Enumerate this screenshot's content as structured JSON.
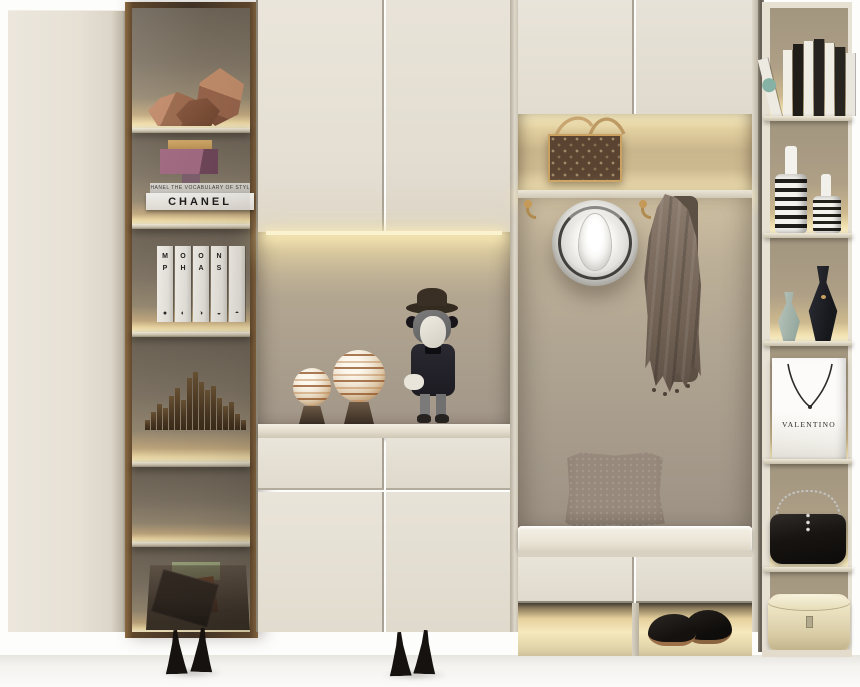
{
  "meta": {
    "description": "3D interior render of a cream built-in entryway wardrobe: glass display tower with lit shelves, cabinet doors, a lit display niche with a collectible figure, a coat area with fedora and scarf on brass hooks, a bench with cushion and shoe cubbies, and an open accessory shelf unit",
    "width": 860,
    "height": 687
  },
  "palette": {
    "cabinet": "#e7e2d7",
    "cabinet_shadow": "#cfc8ba",
    "seam": "#aaa294",
    "wood_frame": "#4e3b2a",
    "tower_wall": "#7d7263",
    "niche_wall": "#b0a592",
    "led_warm": "#f7edc8",
    "brass": "#b08a4e",
    "floor": "#f4f3f0"
  },
  "tower": {
    "shelf_labels": [
      "copper faceted sculptures",
      "sculpture on Chanel books",
      "Moon Phase book set",
      "bronze skyline sculpture",
      "empty lit shelf",
      "smoked acrylic basket with magazines and green box"
    ],
    "chanel": {
      "spine_small": "CHANEL  THE VOCABULARY OF STYLE",
      "spine_large": "CHANEL"
    },
    "moon_books": {
      "visible_text": "MOON PHAS",
      "spines": [
        {
          "t": "M",
          "b": "P",
          "g": "●"
        },
        {
          "t": "O",
          "b": "H",
          "g": "◐"
        },
        {
          "t": "O",
          "b": "A",
          "g": "◑"
        },
        {
          "t": "N",
          "b": "S",
          "g": "◒"
        },
        {
          "t": "",
          "b": "",
          "g": "◓"
        }
      ]
    },
    "skyline_heights": [
      10,
      18,
      26,
      22,
      34,
      42,
      30,
      52,
      58,
      48,
      40,
      44,
      32,
      24,
      28,
      16,
      10
    ]
  },
  "middle": {
    "niche_objects": [
      "small striped orb on stand",
      "large striped orb on stand",
      "gray collectible figure with hat and white gloves"
    ]
  },
  "entry": {
    "bag_label": "monogram canvas handbag with tan straps",
    "hook_count": 2,
    "hat_label": "ivory fedora hat",
    "scarf_label": "taupe patterned scarf",
    "pillow_label": "taupe patterned throw pillow",
    "cushion_label": "cream bench cushion",
    "shoes_label": "black leather derby shoes"
  },
  "right_unit": {
    "books": [
      {
        "c": "#edeae2",
        "h": 60,
        "w": 10,
        "lean": -14,
        "dot": "#86b2a6"
      },
      {
        "c": "#f1eee6",
        "h": 66,
        "w": 9
      },
      {
        "c": "#211e1a",
        "h": 72,
        "w": 10
      },
      {
        "c": "#efece4",
        "h": 75,
        "w": 9
      },
      {
        "c": "#262320",
        "h": 77,
        "w": 10
      },
      {
        "c": "#f0ede5",
        "h": 73,
        "w": 9
      },
      {
        "c": "#282521",
        "h": 69,
        "w": 10
      },
      {
        "c": "#e9e6de",
        "h": 63,
        "w": 9
      }
    ],
    "shelf_labels": [
      "row of art books",
      "black and white striped vases",
      "sage and black ceramic vases",
      "white designer shopping bag",
      "black studded chain shoulder bag",
      "cream round hat box"
    ],
    "valentino_text": "VALENTINO"
  },
  "floor_items": {
    "heels_left": "black ankle-strap heels",
    "heels_middle": "black ankle-strap heels"
  }
}
